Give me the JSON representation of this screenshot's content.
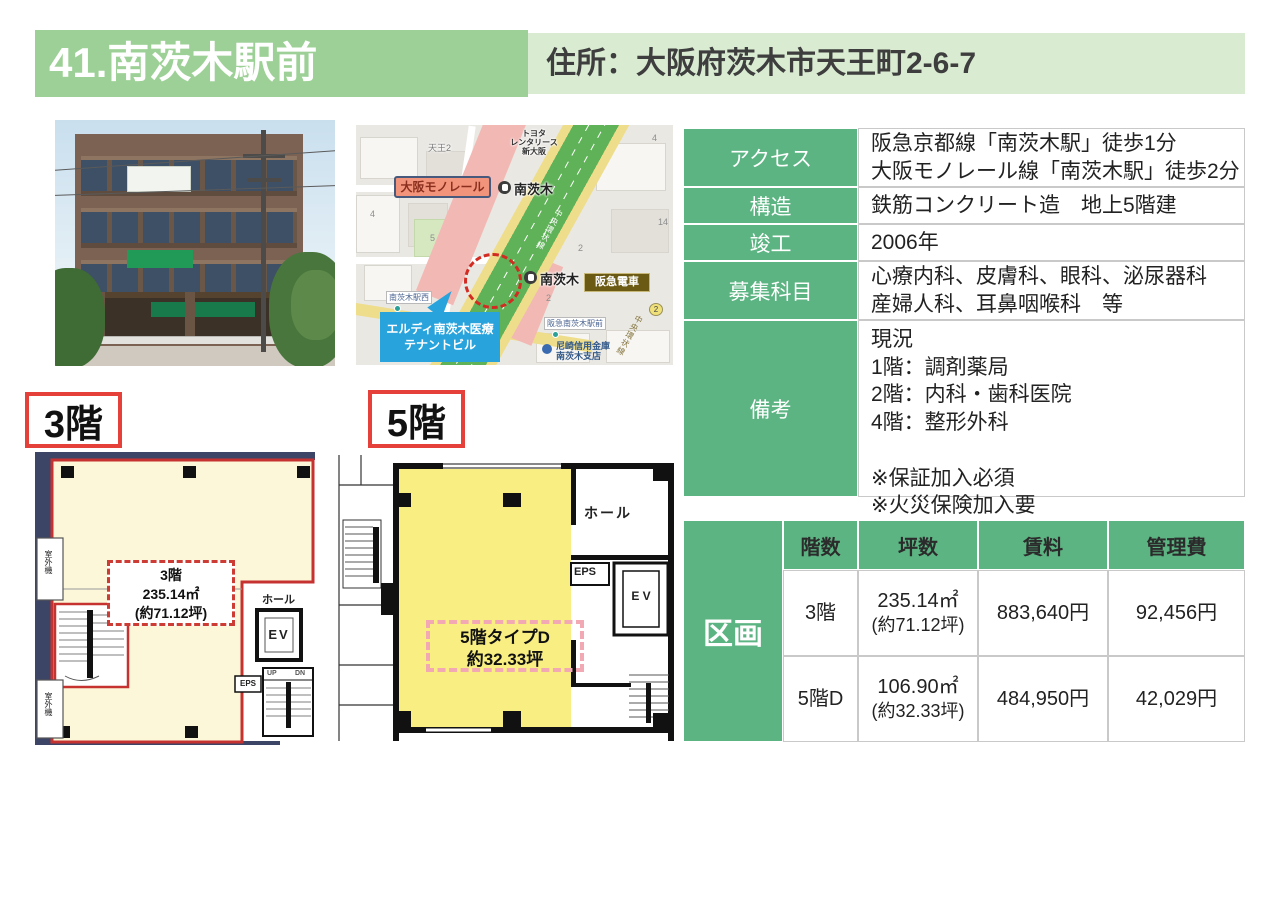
{
  "header": {
    "title": "41.南茨木駅前",
    "address": "住所：大阪府茨木市天王町2-6-7"
  },
  "photo": {
    "sign_blue": "類塾"
  },
  "map": {
    "area_label": "天王2",
    "toyota": "トヨタ\nレンタリース\n新大阪",
    "monorail_badge": "大阪モノレール",
    "station_north": "南茨木",
    "station_south": "南茨木",
    "hankyu_badge": "阪急電車",
    "west_label": "南茨木駅西",
    "ekimae_label": "阪急南茨木駅前",
    "bank_label": "尼崎信用金庫\n南茨木支店",
    "callout": "エルディ南茨木医療\nテナントビル",
    "ring_road": "中央環状線",
    "route_no": "2",
    "block_numbers": [
      "4",
      "2",
      "14",
      "5",
      "4",
      "2"
    ]
  },
  "info_table": {
    "rows": [
      {
        "label": "アクセス",
        "value": "阪急京都線「南茨木駅」徒歩1分\n大阪モノレール線「南茨木駅」徒歩2分"
      },
      {
        "label": "構造",
        "value": "鉄筋コンクリート造　地上5階建"
      },
      {
        "label": "竣工",
        "value": "2006年"
      },
      {
        "label": "募集科目",
        "value": "心療内科、皮膚科、眼科、泌尿器科\n産婦人科、耳鼻咽喉科　等"
      },
      {
        "label": "備考",
        "value": "現況\n1階：調剤薬局\n2階：内科・歯科医院\n4階：整形外科\n\n※保証加入必須\n※火災保険加入要"
      }
    ]
  },
  "plans": {
    "p3": {
      "badge": "3階",
      "ann1": "3階",
      "ann2": "235.14㎡",
      "ann3": "(約71.12坪)",
      "hall": "ホール",
      "ev": "EV",
      "eps": "EPS",
      "up": "UP",
      "dn": "DN",
      "outdoor": "室外機"
    },
    "p5": {
      "badge": "5階",
      "ann1": "5階タイプD",
      "ann2": "約32.33坪",
      "hall": "ホール",
      "ev": "E V",
      "eps": "EPS"
    }
  },
  "price_table": {
    "section": "区画",
    "headers": [
      "階数",
      "坪数",
      "賃料",
      "管理費"
    ],
    "rows": [
      {
        "floor": "3階",
        "size1": "235.14㎡",
        "size2": "(約71.12坪)",
        "rent": "883,640円",
        "fee": "92,456円"
      },
      {
        "floor": "5階D",
        "size1": "106.90㎡",
        "size2": "(約32.33坪)",
        "rent": "484,950円",
        "fee": "42,029円"
      }
    ]
  },
  "colors": {
    "green_table": "#5cb483",
    "green_title": "#9dd096",
    "green_light": "#d9ecd2",
    "red_accent": "#e5403a",
    "callout_blue": "#29a3dc"
  }
}
